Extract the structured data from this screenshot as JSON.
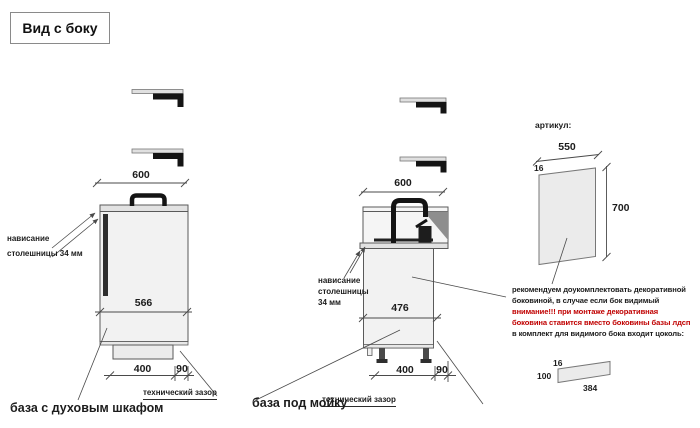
{
  "title": "Вид с боку",
  "cabinet_oven": {
    "caption": "база с духовым шкафом",
    "overhang": [
      "нависание",
      "столешницы 34 мм"
    ],
    "dim_top": "600",
    "dim_inner": "566",
    "dim_plinth": "400",
    "dim_gap": "90",
    "gap_label": "технический зазор"
  },
  "cabinet_sink": {
    "caption": "база под мойку",
    "overhang": [
      "нависание",
      "столешницы",
      "34 мм"
    ],
    "dim_top": "600",
    "dim_inner": "476",
    "dim_plinth": "400",
    "dim_gap": "90",
    "gap_label": "технический зазор"
  },
  "side_panel": {
    "article_label": "артикул:",
    "dim_width": "550",
    "dim_thickness": "16",
    "dim_height": "700",
    "note": [
      "рекомендуем доукомплектовать декоративной",
      "боковиной, в случае если бок видимый",
      "внимание!!! при монтаже декоративная",
      "боковина ставится вместо боковины базы лдсп",
      "в комплект для видимого бока входит цоколь:"
    ],
    "plinth_strip": {
      "dim_thickness": "16",
      "dim_height": "100",
      "dim_length": "384"
    }
  },
  "colors": {
    "warning_red": "#c00000",
    "line": "#4a4a4a",
    "fill_light": "#f2f2f2",
    "fill_counter": "#e2e2e2",
    "dark": "#1d1d1d"
  }
}
